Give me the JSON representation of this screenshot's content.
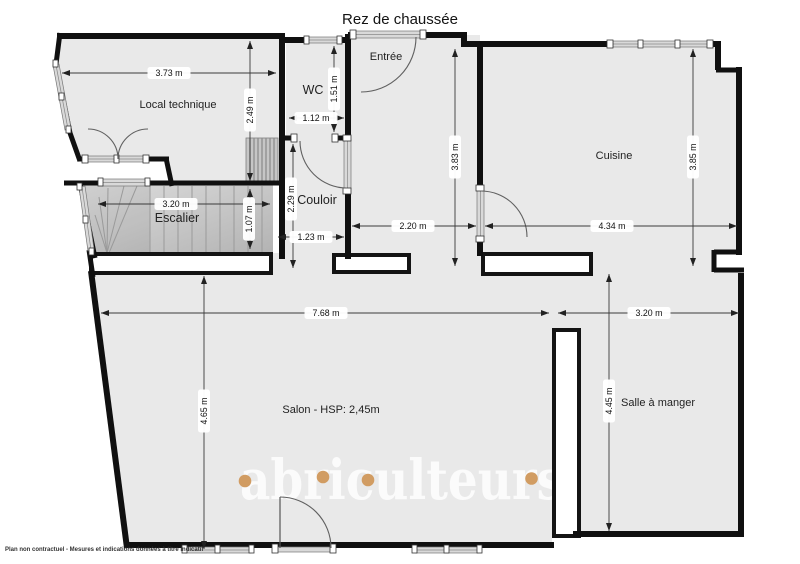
{
  "title": "Rez de chaussée",
  "rooms": {
    "local_technique": "Local technique",
    "wc": "WC",
    "entree": "Entrée",
    "cuisine": "Cuisine",
    "escalier": "Escalier",
    "couloir": "Couloir",
    "salon": "Salon - HSP: 2,45m",
    "salle_a_manger": "Salle à manger"
  },
  "dimensions": {
    "local_technique_width": "3.73 m",
    "local_technique_depth": "2.49 m",
    "wc_depth": "1.51 m",
    "wc_width": "1.12 m",
    "entree_hall_depth": "3.83 m",
    "cuisine_depth": "3.85 m",
    "hall_width": "2.20 m",
    "cuisine_width": "4.34 m",
    "escalier_width": "3.20 m",
    "escalier_depth": "1.07 m",
    "couloir_depth": "2.29 m",
    "couloir_width": "1.23 m",
    "salon_width": "7.68 m",
    "salon_depth": "4.65 m",
    "salle_a_manger_width": "3.20 m",
    "salle_a_manger_depth": "4.45 m"
  },
  "watermark": {
    "text": "abriculteurs",
    "dot_color": "#d19c62"
  },
  "disclaimer": "Plan non contractuel - Mesures et indications données à titre indicatif",
  "colors": {
    "floor": "#e9e9e9",
    "wall": "#101010",
    "accent_dot": "#d19c62"
  }
}
